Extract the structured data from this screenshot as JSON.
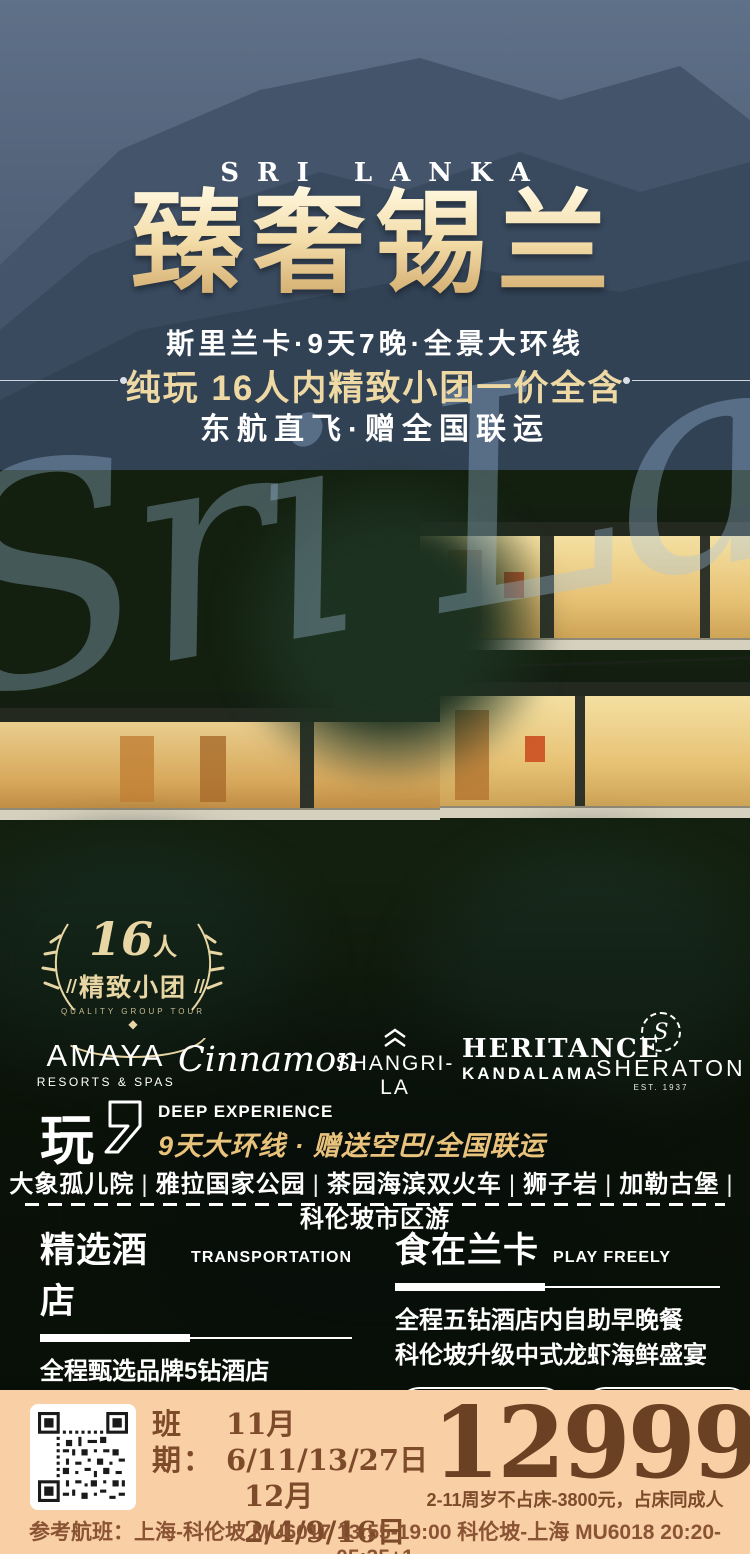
{
  "colors": {
    "gold": "#eed9a4",
    "title_gold_light": "#fff8e0",
    "title_gold_dark": "#cfa768",
    "footer_bg": "#f9cfa5",
    "footer_brown": "#7d4a2a",
    "price_brown": "#6b4123",
    "white": "#ffffff"
  },
  "hero": {
    "kicker": "SRI LANKA",
    "title": "臻奢锡兰",
    "watermark": "Sri Lanka",
    "subtitle1": "斯里兰卡·9天7晚·全景大环线",
    "subtitle2": "纯玩 16人内精致小团一价全含",
    "subtitle3": "东航直飞·赠全国联运"
  },
  "badge": {
    "number": "16",
    "unit": "人",
    "label": "精致小团",
    "caption": "QUALITY GROUP TOUR",
    "gem": "◆"
  },
  "brands": {
    "amaya_line1": "AMAYA",
    "amaya_line2": "RESORTS & SPAS",
    "cinnamon": "Cinnamon",
    "shangrila": "SHANGRI-LA",
    "heritance_line1": "HERITANCE",
    "heritance_line2": "KANDALAMA",
    "sheraton_mark": "S",
    "sheraton": "SHERATON",
    "sheraton_sub": "EST. 1937"
  },
  "experience": {
    "play": "玩",
    "en": "DEEP EXPERIENCE",
    "line": "9天大环线 · 赠送空巴/全国联运"
  },
  "attractions": {
    "separator": "|",
    "items": [
      "大象孤儿院",
      "雅拉国家公园",
      "茶园海滨双火车",
      "狮子岩",
      "加勒古堡",
      "科伦坡市区游"
    ]
  },
  "columns": {
    "left": {
      "title": "精选酒店",
      "en": "TRANSPORTATION",
      "line1": "全程甄选品牌5钻酒店",
      "line2": "海滨升级两晚国际5星",
      "pill1": "跟团游顶配 严选线路"
    },
    "right": {
      "title": "食在兰卡",
      "en": "PLAY FREELY",
      "line1": "全程五钻酒店内自助早晚餐",
      "line2": "科伦坡升级中式龙虾海鲜盛宴",
      "pill1": "金牌领队服务",
      "pill2": "精选景点打卡"
    }
  },
  "footer": {
    "schedule_label": "班期：",
    "dates_line1": "11月6/11/13/27日",
    "dates_line2": "12月2/4/9/16日",
    "departure": "DEPARTURE DATE",
    "price": "12999",
    "currency": "元",
    "per": "人",
    "price_note": "2-11周岁不占床-3800元，占床同成人",
    "flights": "参考航班：上海-科伦坡 MU6017 13:55-19:00 科伦坡-上海 MU6018 20:20-05:35+1"
  }
}
